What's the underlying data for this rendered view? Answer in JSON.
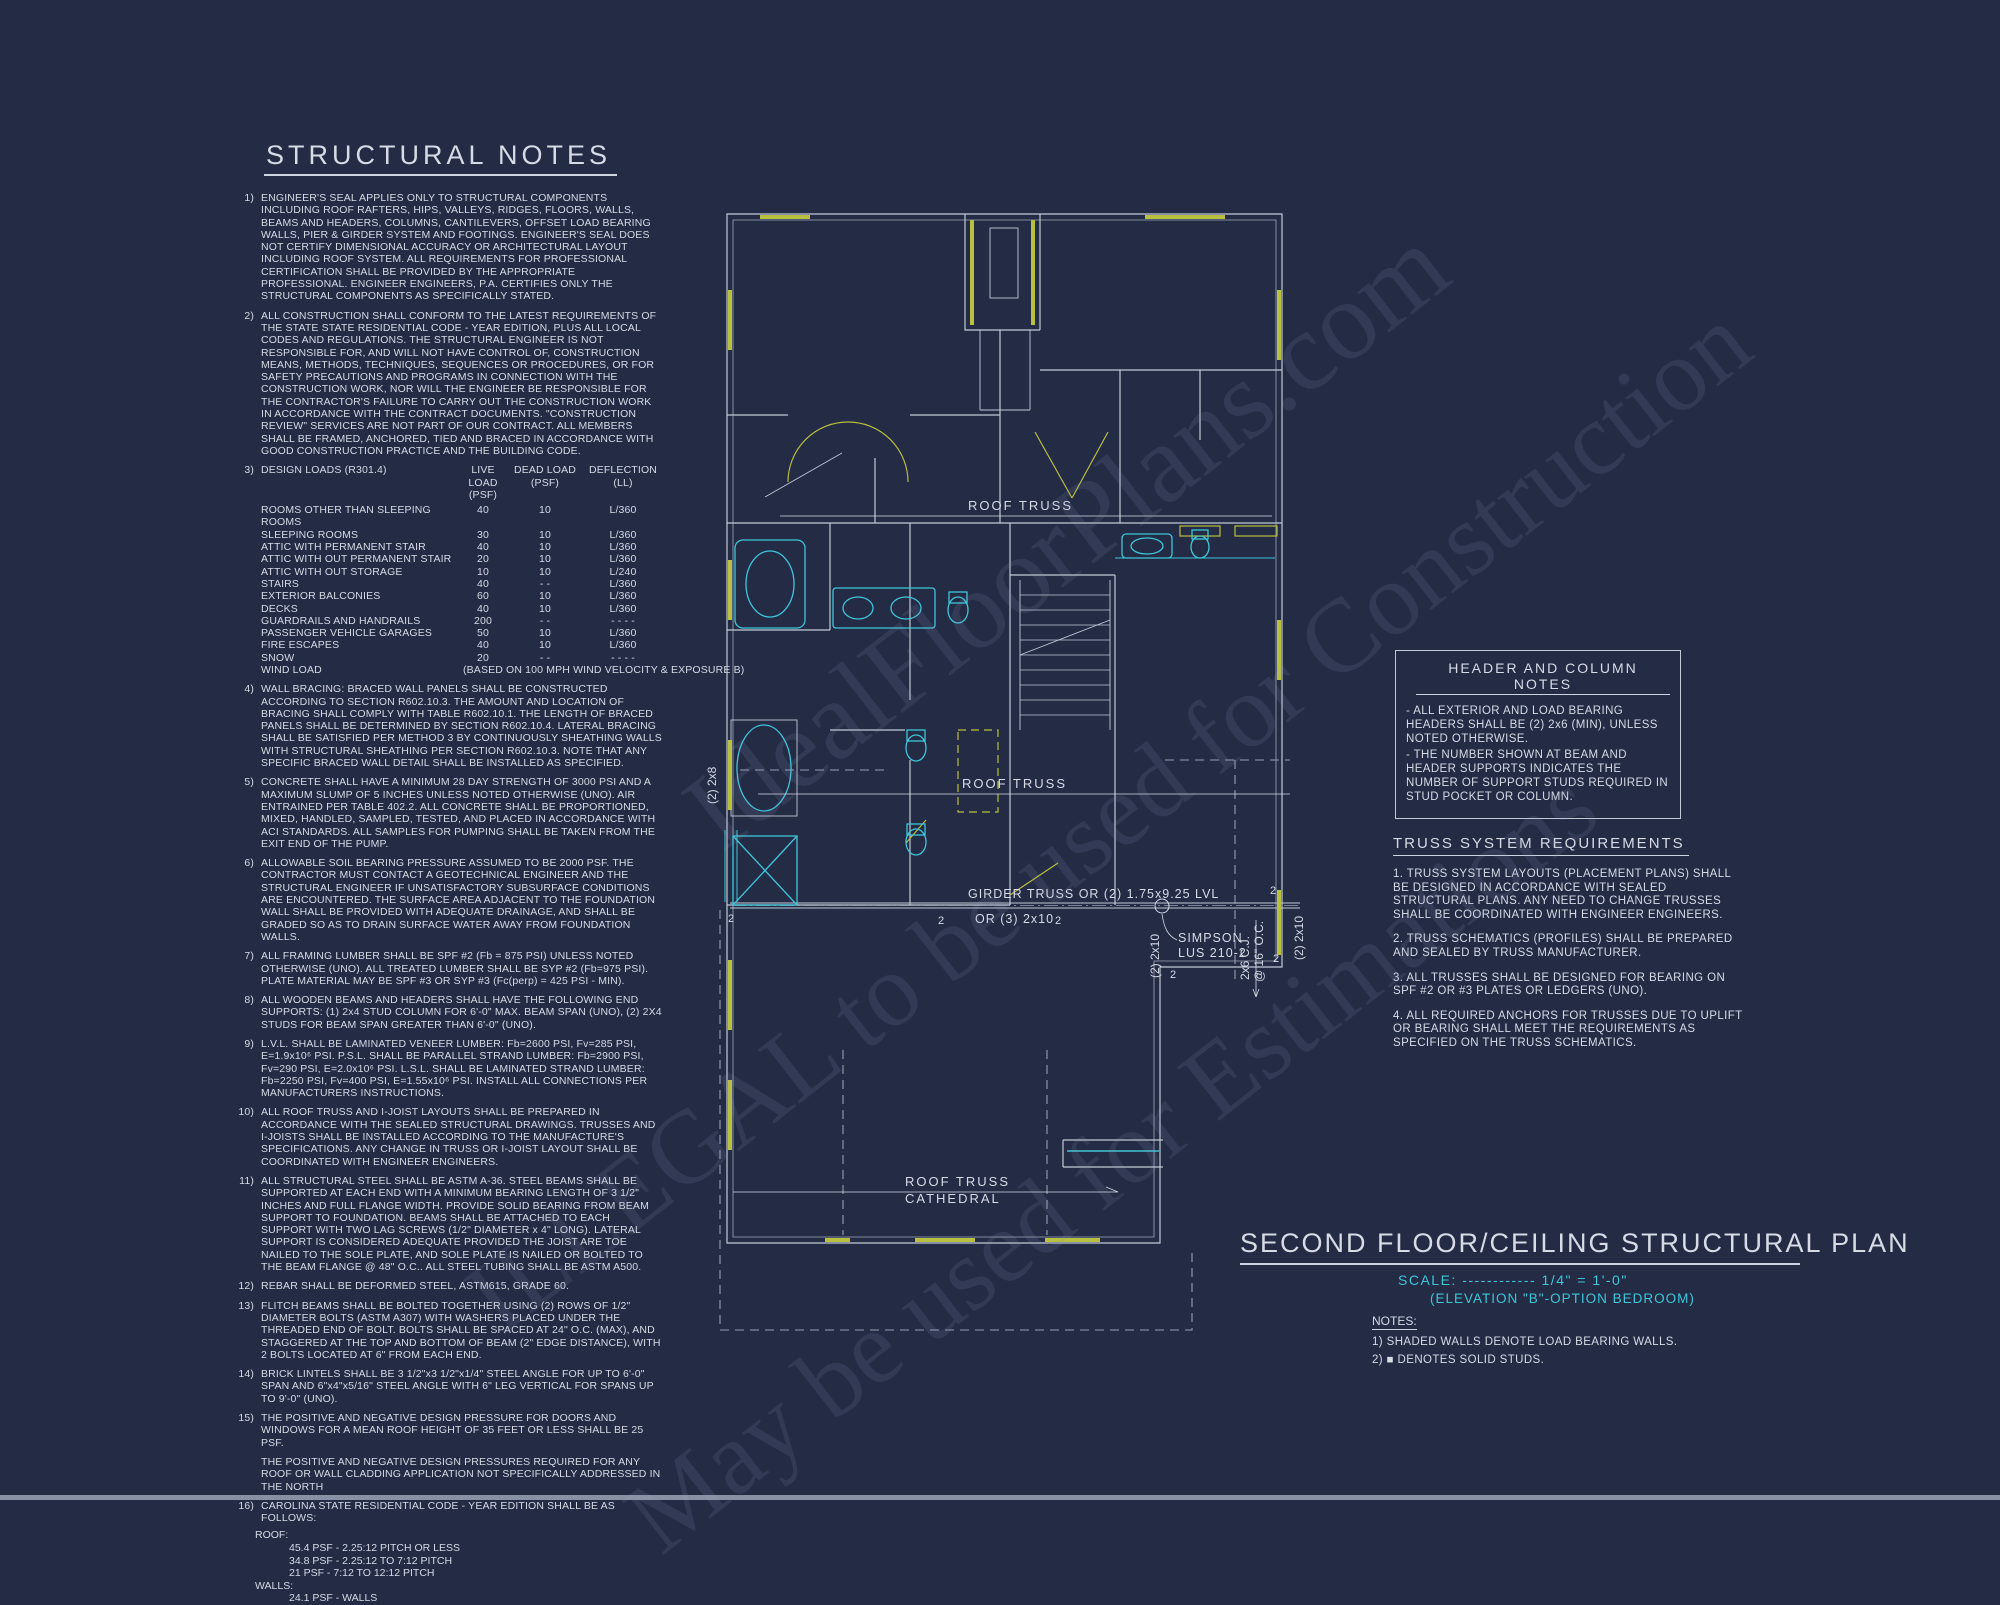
{
  "colors": {
    "background": "#232b45",
    "ink": "#d6dbe6",
    "cyan": "#3fc6d8",
    "yellow": "#b9bf3e",
    "wall": "#c2c9d6",
    "dash": "#96a0b4"
  },
  "watermark": {
    "line1": "IdealFloorPlans.com",
    "line2": "ILLEGAL to be used for Construction",
    "line3": "May be used for Estimations"
  },
  "structural_notes": {
    "title": "STRUCTURAL NOTES",
    "notes": [
      {
        "num": "1)",
        "text": "ENGINEER'S SEAL APPLIES ONLY TO STRUCTURAL COMPONENTS INCLUDING ROOF RAFTERS, HIPS, VALLEYS, RIDGES, FLOORS, WALLS, BEAMS AND HEADERS, COLUMNS, CANTILEVERS, OFFSET LOAD BEARING WALLS, PIER & GIRDER SYSTEM AND FOOTINGS.  ENGINEER'S SEAL DOES NOT CERTIFY DIMENSIONAL ACCURACY OR ARCHITECTURAL LAYOUT INCLUDING ROOF SYSTEM. ALL REQUIREMENTS FOR PROFESSIONAL CERTIFICATION SHALL BE PROVIDED BY THE APPROPRIATE PROFESSIONAL. ENGINEER ENGINEERS, P.A. CERTIFIES ONLY THE STRUCTURAL COMPONENTS AS SPECIFICALLY STATED."
      },
      {
        "num": "2)",
        "text": "ALL CONSTRUCTION SHALL CONFORM TO THE LATEST REQUIREMENTS OF THE STATE STATE RESIDENTIAL CODE - YEAR EDITION, PLUS ALL LOCAL CODES AND REGULATIONS. THE STRUCTURAL ENGINEER IS NOT RESPONSIBLE FOR, AND WILL NOT HAVE CONTROL OF, CONSTRUCTION MEANS, METHODS, TECHNIQUES, SEQUENCES OR PROCEDURES, OR FOR SAFETY PRECAUTIONS AND PROGRAMS IN CONNECTION WITH THE CONSTRUCTION WORK, NOR WILL THE ENGINEER BE RESPONSIBLE FOR THE CONTRACTOR'S FAILURE TO CARRY OUT THE CONSTRUCTION WORK IN ACCORDANCE WITH THE CONTRACT DOCUMENTS. \"CONSTRUCTION REVIEW\" SERVICES ARE NOT PART OF OUR CONTRACT. ALL MEMBERS SHALL BE FRAMED, ANCHORED, TIED AND BRACED IN ACCORDANCE WITH GOOD CONSTRUCTION PRACTICE AND THE BUILDING CODE."
      },
      {
        "num": "4)",
        "text": "WALL BRACING:  BRACED WALL PANELS SHALL BE CONSTRUCTED ACCORDING TO SECTION R602.10.3. THE AMOUNT AND LOCATION OF BRACING SHALL COMPLY WITH TABLE R602.10.1. THE LENGTH OF BRACED PANELS SHALL BE DETERMINED BY SECTION R602.10.4. LATERAL BRACING SHALL BE SATISFIED PER METHOD 3 BY CONTINUOUSLY SHEATHING WALLS WITH STRUCTURAL SHEATHING PER SECTION R602.10.3. NOTE THAT ANY SPECIFIC BRACED WALL DETAIL SHALL BE INSTALLED AS SPECIFIED."
      },
      {
        "num": "5)",
        "text": "CONCRETE SHALL HAVE A MINIMUM 28 DAY STRENGTH OF 3000 PSI AND A MAXIMUM SLUMP OF 5 INCHES UNLESS NOTED OTHERWISE (UNO). AIR ENTRAINED PER TABLE 402.2. ALL CONCRETE SHALL BE PROPORTIONED, MIXED, HANDLED, SAMPLED, TESTED, AND PLACED IN ACCORDANCE WITH ACI STANDARDS. ALL SAMPLES FOR PUMPING SHALL BE TAKEN FROM THE EXIT END OF THE PUMP."
      },
      {
        "num": "6)",
        "text": "ALLOWABLE SOIL BEARING PRESSURE ASSUMED TO BE 2000 PSF. THE CONTRACTOR MUST CONTACT A GEOTECHNICAL ENGINEER AND THE STRUCTURAL ENGINEER IF UNSATISFACTORY SUBSURFACE CONDITIONS ARE ENCOUNTERED. THE SURFACE AREA ADJACENT TO THE FOUNDATION WALL SHALL BE PROVIDED WITH ADEQUATE DRAINAGE, AND SHALL BE GRADED SO AS TO DRAIN SURFACE WATER AWAY FROM FOUNDATION WALLS."
      },
      {
        "num": "7)",
        "text": "ALL FRAMING LUMBER SHALL BE SPF #2 (Fb = 875 PSI) UNLESS NOTED OTHERWISE (UNO). ALL TREATED LUMBER SHALL BE SYP #2 (Fb=975 PSI). PLATE MATERIAL MAY BE SPF #3 OR SYP #3 (Fc(perp) = 425 PSI - MIN)."
      },
      {
        "num": "8)",
        "text": "ALL WOODEN BEAMS AND HEADERS SHALL HAVE THE FOLLOWING END SUPPORTS: (1) 2x4 STUD COLUMN FOR 6'-0\" MAX. BEAM SPAN (UNO), (2) 2X4 STUDS FOR BEAM SPAN GREATER THAN 6'-0\" (UNO)."
      },
      {
        "num": "9)",
        "text": "L.V.L.  SHALL BE LAMINATED VENEER LUMBER: Fb=2600 PSI, Fv=285 PSI, E=1.9x10⁶ PSI. P.S.L.  SHALL BE PARALLEL STRAND LUMBER: Fb=2900 PSI, Fv=290 PSI, E=2.0x10⁶ PSI. L.S.L.  SHALL BE LAMINATED STRAND LUMBER: Fb=2250 PSI, Fv=400 PSI, E=1.55x10⁶ PSI. INSTALL ALL CONNECTIONS PER MANUFACTURERS INSTRUCTIONS."
      },
      {
        "num": "10)",
        "text": "ALL ROOF TRUSS AND I-JOIST LAYOUTS SHALL BE PREPARED IN ACCORDANCE WITH THE SEALED STRUCTURAL DRAWINGS. TRUSSES AND I-JOISTS SHALL BE INSTALLED ACCORDING TO THE MANUFACTURE'S SPECIFICATIONS. ANY CHANGE IN TRUSS OR I-JOIST LAYOUT SHALL BE COORDINATED WITH ENGINEER ENGINEERS."
      },
      {
        "num": "11)",
        "text": "ALL STRUCTURAL STEEL SHALL BE ASTM A-36. STEEL BEAMS SHALL BE SUPPORTED AT EACH END WITH A MINIMUM BEARING LENGTH OF 3 1/2\" INCHES AND FULL FLANGE WIDTH. PROVIDE SOLID BEARING FROM BEAM SUPPORT TO FOUNDATION.  BEAMS SHALL BE ATTACHED TO EACH SUPPORT WITH TWO LAG SCREWS (1/2\" DIAMETER x 4\" LONG). LATERAL SUPPORT IS CONSIDERED ADEQUATE PROVIDED THE JOIST ARE TOE NAILED TO THE SOLE PLATE, AND SOLE PLATE IS NAILED OR BOLTED TO THE BEAM FLANGE @ 48\" O.C.. ALL STEEL TUBING SHALL BE ASTM A500."
      },
      {
        "num": "12)",
        "text": "REBAR SHALL BE DEFORMED STEEL, ASTM615, GRADE 60."
      },
      {
        "num": "13)",
        "text": "FLITCH BEAMS SHALL BE BOLTED TOGETHER USING (2) ROWS OF 1/2\" DIAMETER BOLTS (ASTM A307) WITH WASHERS PLACED UNDER THE THREADED END OF BOLT.  BOLTS SHALL BE SPACED AT 24\" O.C. (MAX), AND STAGGERED AT THE TOP AND BOTTOM OF BEAM (2\" EDGE DISTANCE), WITH 2 BOLTS LOCATED AT 6\" FROM EACH END."
      },
      {
        "num": "14)",
        "text": "BRICK LINTELS SHALL BE 3 1/2\"x3 1/2\"x1/4\" STEEL ANGLE FOR UP TO 6'-0\" SPAN AND 6\"x4\"x5/16\" STEEL ANGLE WITH 6\" LEG VERTICAL FOR SPANS UP TO 9'-0\" (UNO)."
      },
      {
        "num": "15)",
        "text": "THE POSITIVE AND NEGATIVE DESIGN PRESSURE FOR DOORS AND WINDOWS FOR A MEAN ROOF HEIGHT OF 35 FEET OR LESS SHALL BE 25 PSF."
      },
      {
        "num": "",
        "text": "THE POSITIVE AND NEGATIVE DESIGN PRESSURES REQUIRED FOR ANY ROOF OR WALL CLADDING APPLICATION NOT SPECIFICALLY ADDRESSED IN THE NORTH"
      },
      {
        "num": "16)",
        "text": "CAROLINA STATE RESIDENTIAL CODE - YEAR EDITION SHALL BE AS FOLLOWS:"
      }
    ]
  },
  "design_loads": {
    "num": "3)",
    "label": "DESIGN LOADS (R301.4)",
    "headers": {
      "live": "LIVE LOAD",
      "live_unit": "(PSF)",
      "dead": "DEAD LOAD",
      "dead_unit": "(PSF)",
      "defl": "DEFLECTION",
      "defl_unit": "(LL)"
    },
    "rows": [
      {
        "name": "ROOMS OTHER THAN SLEEPING ROOMS",
        "live": "40",
        "dead": "10",
        "defl": "L/360"
      },
      {
        "name": "SLEEPING ROOMS",
        "live": "30",
        "dead": "10",
        "defl": "L/360"
      },
      {
        "name": "ATTIC WITH PERMANENT STAIR",
        "live": "40",
        "dead": "10",
        "defl": "L/360"
      },
      {
        "name": "ATTIC WITH OUT PERMANENT STAIR",
        "live": "20",
        "dead": "10",
        "defl": "L/360"
      },
      {
        "name": "ATTIC WITH OUT STORAGE",
        "live": "10",
        "dead": "10",
        "defl": "L/240"
      },
      {
        "name": "STAIRS",
        "live": "40",
        "dead": "- -",
        "defl": "L/360"
      },
      {
        "name": "EXTERIOR BALCONIES",
        "live": "60",
        "dead": "10",
        "defl": "L/360"
      },
      {
        "name": "DECKS",
        "live": "40",
        "dead": "10",
        "defl": "L/360"
      },
      {
        "name": "GUARDRAILS AND HANDRAILS",
        "live": "200",
        "dead": "- -",
        "defl": "- - - -"
      },
      {
        "name": "PASSENGER VEHICLE GARAGES",
        "live": "50",
        "dead": "10",
        "defl": "L/360"
      },
      {
        "name": "FIRE ESCAPES",
        "live": "40",
        "dead": "10",
        "defl": "L/360"
      },
      {
        "name": "SNOW",
        "live": "20",
        "dead": "- -",
        "defl": "- - - -"
      }
    ],
    "wind": {
      "name": "WIND LOAD",
      "note": "(BASED ON 100 MPH WIND VELOCITY & EXPOSURE B)"
    }
  },
  "note16_detail": {
    "roof_label": "ROOF:",
    "roof_items": [
      "45.4 PSF - 2.25:12 PITCH OR LESS",
      "34.8 PSF - 2.25:12 TO 7:12 PITCH",
      "21 PSF - 7:12 TO 12:12 PITCH"
    ],
    "walls_label": "WALLS:",
    "walls_items": [
      "24.1 PSF - WALLS"
    ]
  },
  "header_column_notes": {
    "title": "HEADER AND COLUMN NOTES",
    "items": [
      "- ALL EXTERIOR AND LOAD BEARING HEADERS SHALL BE (2) 2x6 (MIN), UNLESS NOTED OTHERWISE.",
      "- THE NUMBER SHOWN AT BEAM AND HEADER SUPPORTS INDICATES THE NUMBER OF SUPPORT STUDS REQUIRED IN STUD POCKET OR COLUMN."
    ]
  },
  "truss_requirements": {
    "title": "TRUSS SYSTEM REQUIREMENTS",
    "items": [
      "1. TRUSS SYSTEM LAYOUTS (PLACEMENT PLANS) SHALL BE DESIGNED IN ACCORDANCE WITH SEALED STRUCTURAL PLANS. ANY NEED TO CHANGE TRUSSES SHALL BE COORDINATED WITH ENGINEER ENGINEERS.",
      "2. TRUSS SCHEMATICS (PROFILES) SHALL BE PREPARED AND SEALED BY TRUSS MANUFACTURER.",
      "3. ALL TRUSSES SHALL BE DESIGNED FOR BEARING ON SPF #2 OR #3 PLATES OR LEDGERS (UNO).",
      "4. ALL REQUIRED ANCHORS FOR TRUSSES DUE TO UPLIFT OR BEARING SHALL MEET THE REQUIREMENTS AS SPECIFIED ON THE TRUSS SCHEMATICS."
    ]
  },
  "title_block": {
    "title": "SECOND FLOOR/CEILING STRUCTURAL PLAN",
    "scale": "SCALE: ------------ 1/4\" = 1'-0\"",
    "elevation": "(ELEVATION \"B\"-OPTION BEDROOM)",
    "notes_label": "NOTES:",
    "note1": "1) SHADED WALLS DENOTE LOAD BEARING WALLS.",
    "note2": "2) ■ DENOTES SOLID STUDS."
  },
  "plan_labels": {
    "roof_truss_upper": "ROOF TRUSS",
    "roof_truss_mid": "ROOF TRUSS",
    "girder": "GIRDER TRUSS OR (2) 1.75x9.25 LVL",
    "girder_alt": "OR (3) 2x10",
    "beam_2x8": "(2) 2x8",
    "beam_2x10_a": "(2) 2x10",
    "beam_2x10_b": "(2) 2x10",
    "simpson_1": "SIMPSON",
    "simpson_2": "LUS 210-2",
    "cj_1": "2x6 C.J.",
    "cj_2": "@ 16\" O.C.",
    "cathedral_1": "ROOF TRUSS",
    "cathedral_2": "CATHEDRAL",
    "stud": "2"
  }
}
